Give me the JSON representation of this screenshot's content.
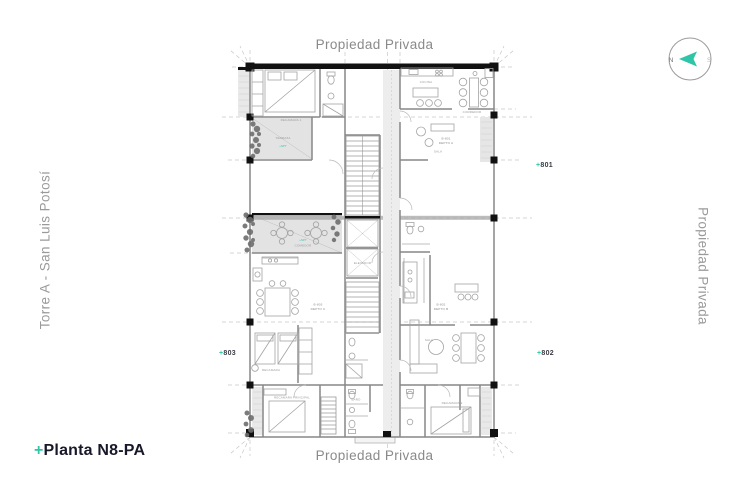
{
  "page": {
    "top_label": "Propiedad Privada",
    "bottom_label": "Propiedad Privada",
    "left_label": "Torre A - San Luis Potosí",
    "right_label": "Propiedad Privada",
    "plan_name_plus": "+",
    "plan_name": "Planta N8-PA"
  },
  "compass": {
    "left_letter": "N",
    "right_letter": "S"
  },
  "units": [
    {
      "plus": "+",
      "number": "801"
    },
    {
      "plus": "+",
      "number": "802"
    },
    {
      "plus": "+",
      "number": "803"
    }
  ],
  "plan": {
    "rooms": [
      {
        "text": "RECAMARA 1"
      },
      {
        "text": "TERRAZA"
      },
      {
        "text": "+NPT"
      },
      {
        "text": "COCINA"
      },
      {
        "text": "B-801"
      },
      {
        "text": "DEPTO A"
      },
      {
        "text": "SALA"
      },
      {
        "text": "ELEVADOR"
      },
      {
        "text": "+NPT"
      },
      {
        "text": "COMEDOR"
      },
      {
        "text": "B-803"
      },
      {
        "text": "DEPTO C"
      },
      {
        "text": "RECAMARA"
      },
      {
        "text": "B-802"
      },
      {
        "text": "DEPTO B"
      },
      {
        "text": "SALA"
      },
      {
        "text": "RECAMARA PRINCIPAL"
      },
      {
        "text": "RECAMARA 2"
      },
      {
        "text": "BAÑO"
      },
      {
        "text": "CORREDOR"
      }
    ]
  },
  "colors": {
    "accent": "#2EC5A8",
    "muted_text": "#8A8A8A",
    "dark_text": "#18182A",
    "plan_lines": "#878787"
  }
}
